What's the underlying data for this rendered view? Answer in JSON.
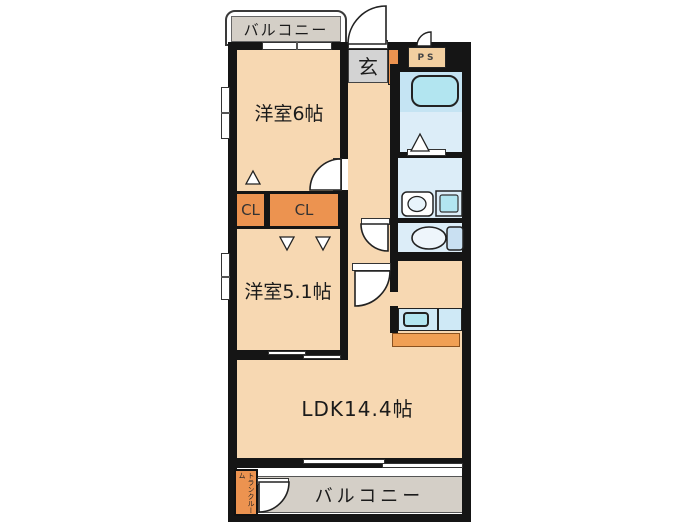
{
  "type": "floor_plan",
  "labels": {
    "balcony_top": "バルコニー",
    "balcony_bottom": "バルコニー",
    "genkan": "玄",
    "ps": "PS",
    "room1": "洋室6帖",
    "room2": "洋室5.1帖",
    "ldk": "LDK14.4帖",
    "closet_left": "CL",
    "closet_right": "CL",
    "trunk_line1": "トランク",
    "trunk_line2": "ルーム"
  },
  "colors": {
    "wall": "#151515",
    "room_fill": "#f7d8b2",
    "closet_fill": "#ec9350",
    "wet_area_fill": "#dcedf8",
    "bath_upper_fill": "#c5e4f3",
    "fixture_cyan": "#b2e5f0",
    "balcony_fill": "#d4cfc7",
    "genkan_fill": "#d3d3d3",
    "ps_fill": "#f2cfa0",
    "kitchen_counter_fill": "#cfe9f6",
    "kitchen_bar_fill": "#f0a055"
  }
}
